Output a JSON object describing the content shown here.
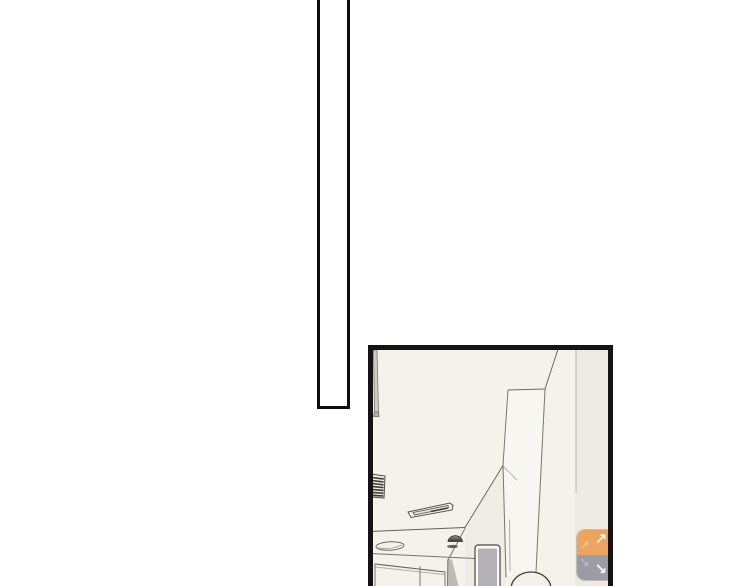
{
  "page": {
    "background_color": "#ffffff"
  },
  "comic": {
    "tall_panel": {
      "fill_color": "#ffffff",
      "border_color": "#0d0d0d"
    },
    "scene_panel": {
      "border_color": "#141414",
      "wall_color": "#f5f2ec",
      "right_wall_color": "#edeae3",
      "pillar_color": "#f8f6f0",
      "soffit_color": "#f0ede6",
      "line_color": "#7b756c",
      "vent_color": "#3f3b35",
      "window_glass_color": "#b3b1b5",
      "window_frame_color": "#fbf9f4",
      "counter_object_dark_color": "#3c3730"
    }
  },
  "nav_buttons": {
    "up": {
      "glyph": "↗",
      "background_color": "#eda45f"
    },
    "down": {
      "glyph": "↘",
      "background_color": "#9c9ca6"
    }
  }
}
